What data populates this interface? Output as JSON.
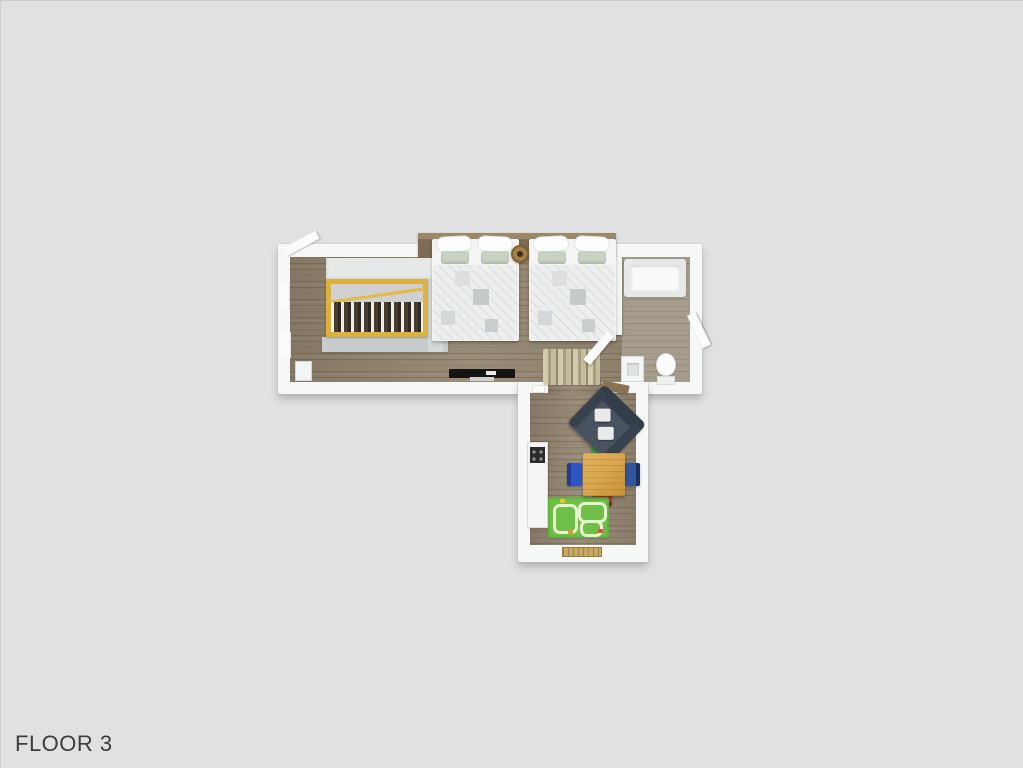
{
  "page": {
    "label": "FLOOR 3"
  },
  "scene": {
    "type": "3d-floor-plan-top-view",
    "rooms": [
      {
        "name": "bedroom-landing",
        "items": [
          "staircase",
          "double-bed",
          "double-bed",
          "nightstand",
          "wall-tv",
          "radiator",
          "runner-rug",
          "open-door"
        ]
      },
      {
        "name": "bathroom",
        "items": [
          "bathtub",
          "washbasin",
          "toilet",
          "door",
          "wardrobe"
        ]
      },
      {
        "name": "living-kitchen",
        "items": [
          "corner-sofa",
          "kitchen-unit-with-hob",
          "dining-table",
          "chair-green",
          "chair-blue",
          "chair-navy",
          "chair-red",
          "kids-play-mat",
          "door-threshold",
          "wall-shelf"
        ]
      }
    ],
    "colors": {
      "background": "#e0e1e0",
      "walls": "#f6f7f7",
      "wood_floor": "#93856f",
      "stair_rail_wood": "#dcb13e",
      "headboard_wood": "#7d6b53",
      "sofa": "#49525f",
      "dining_table": "#d9a74f",
      "chair_green": "#35a254",
      "chair_blue": "#2f55c4",
      "chair_navy": "#33549f",
      "chair_red": "#c13340",
      "play_mat_green": "#6fbf49",
      "pillow_sage": "#c7d2c3",
      "label_text": "#3a3e3d"
    }
  }
}
